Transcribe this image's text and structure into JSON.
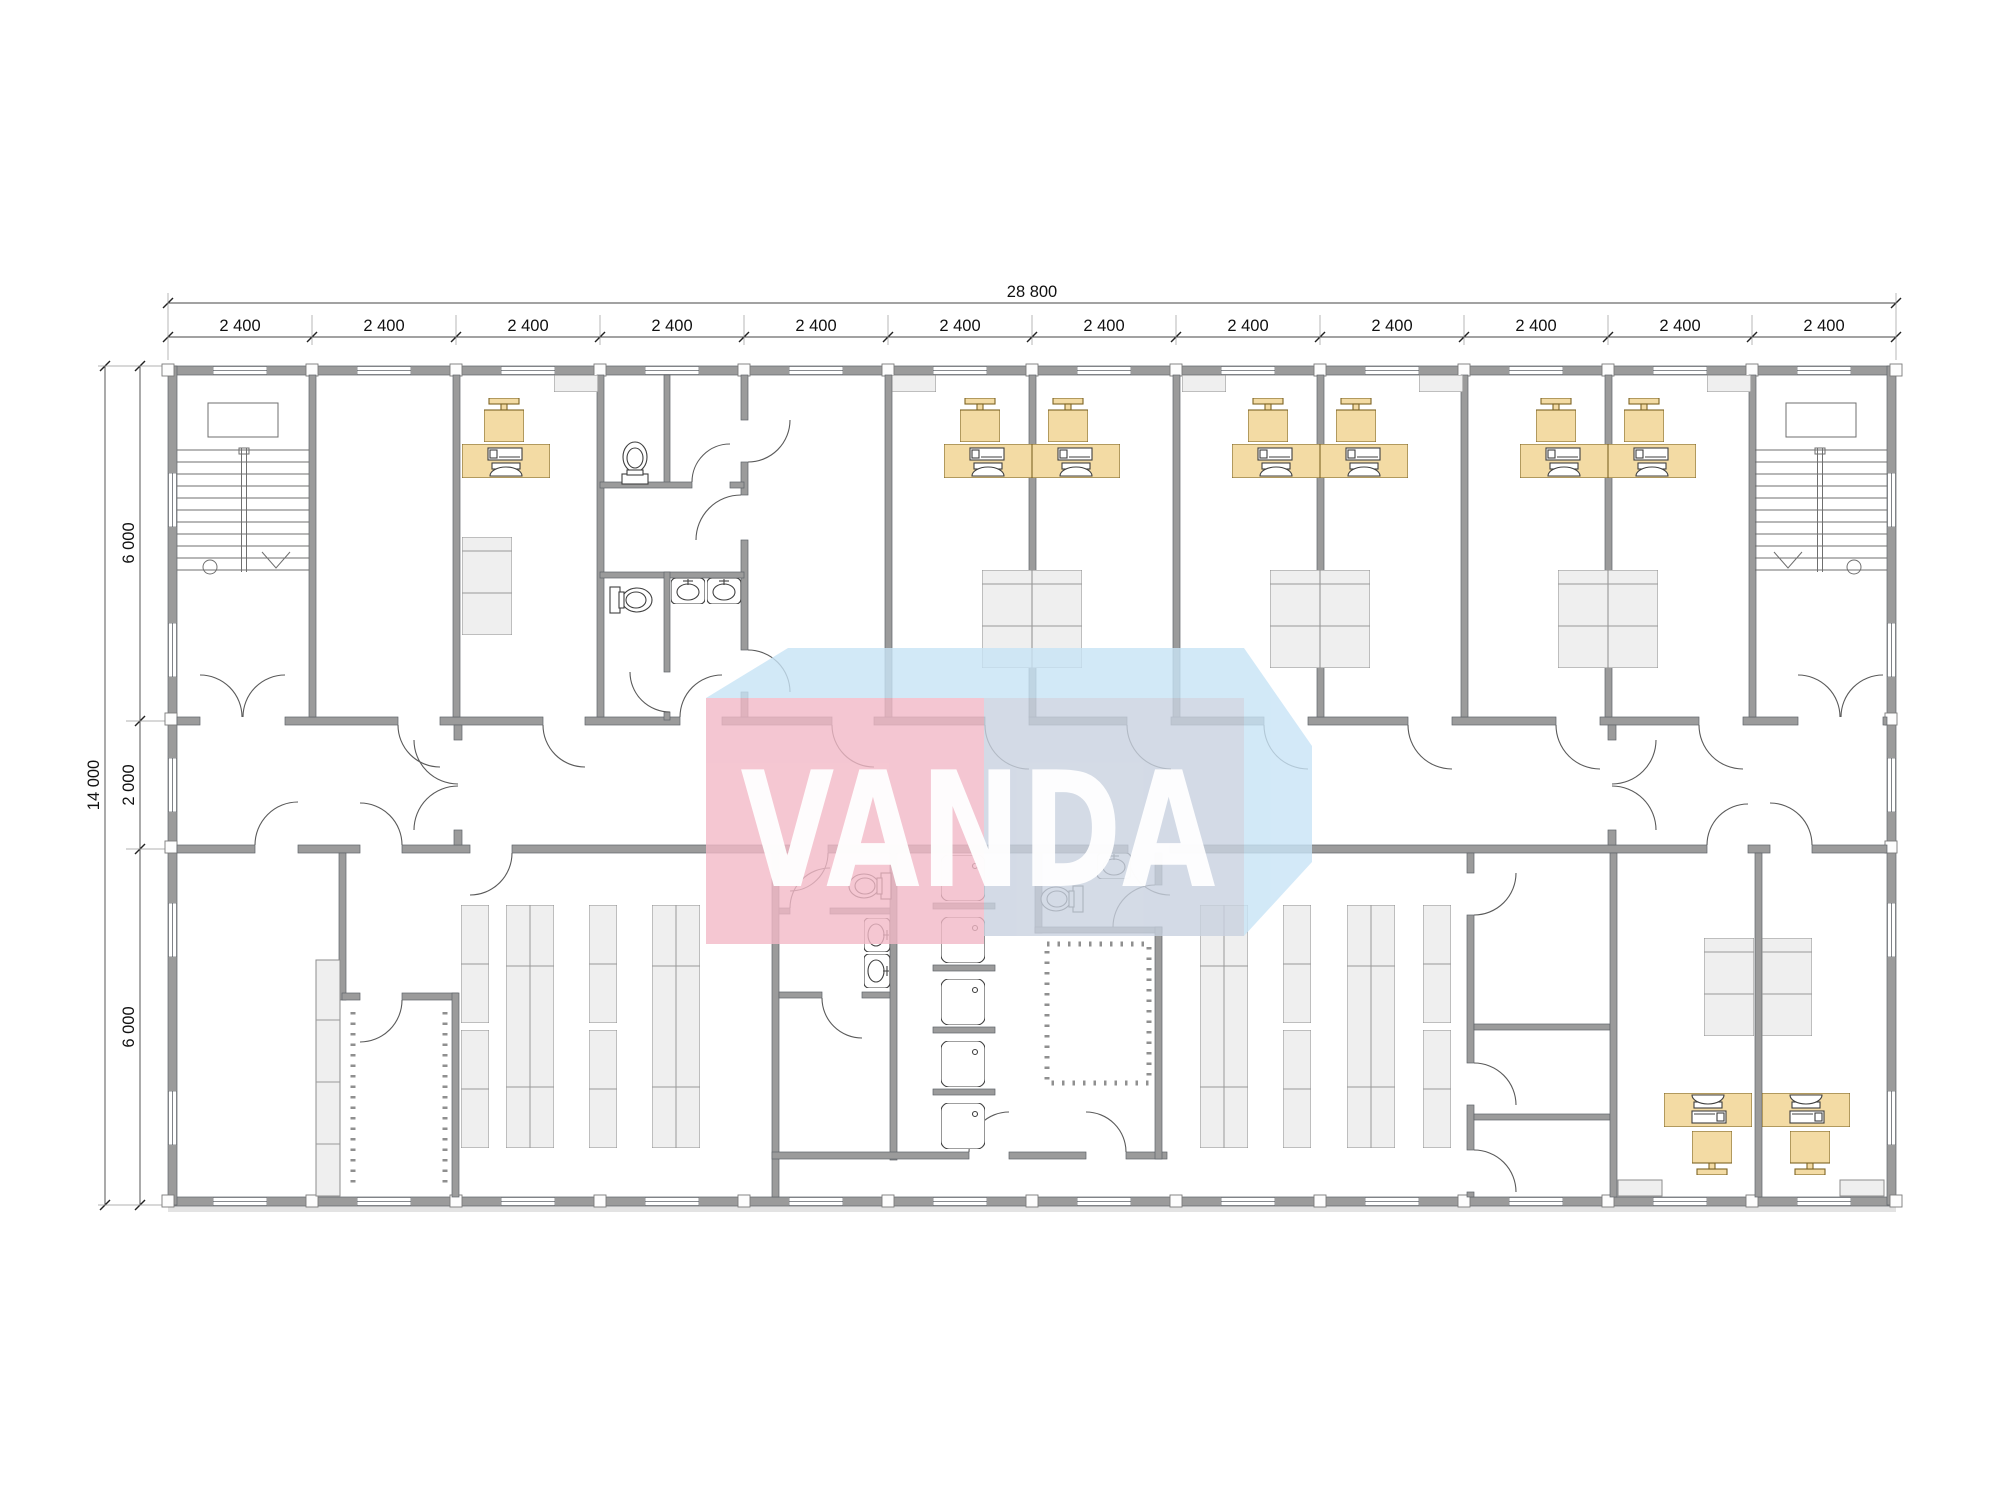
{
  "drawing": {
    "type": "floor-plan",
    "watermark_text": "VANDA"
  },
  "dims": {
    "total_width_label": "28 800",
    "top_segment_labels": [
      "2 400",
      "2 400",
      "2 400",
      "2 400",
      "2 400",
      "2 400",
      "2 400",
      "2 400",
      "2 400",
      "2 400",
      "2 400",
      "2 400"
    ],
    "total_height_label": "14 000",
    "left_segment_labels": [
      "6 000",
      "2 000",
      "6 000"
    ]
  },
  "colors": {
    "wall": "#9b9b9b",
    "wall_stroke": "#60646a",
    "furniture_fill": "#f3dba4",
    "furniture_stroke": "#7d6425",
    "fixture_fill": "#efefef",
    "fixture_stroke": "#8d8d8d",
    "wm_pink": "#f2b9c7",
    "wm_blue": "#c8e4f6",
    "wm_gray": "#c9d2e0",
    "wm_text": "#ffffff"
  }
}
